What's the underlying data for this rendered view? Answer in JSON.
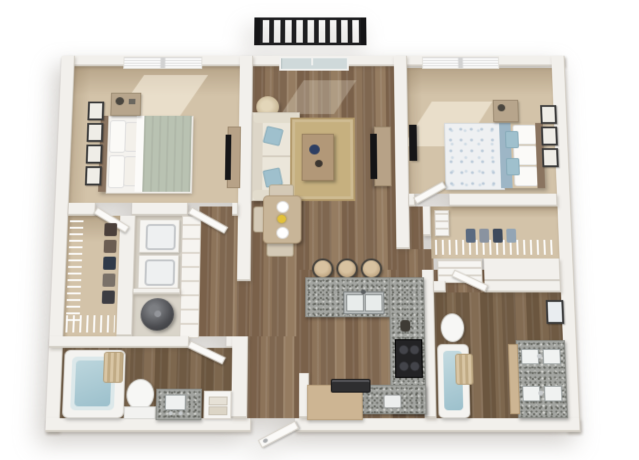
{
  "meta": {
    "render_style": "3d top-down dollhouse floor plan",
    "visible_text": ""
  },
  "palette": {
    "background": "#ffffff",
    "wall": "#f2f0ec",
    "carpet": "#d3c3a9",
    "wood": "#876e54",
    "wood_dark": "#75604a",
    "granite": "#a3a5a1",
    "counter_tan": "#cdb593",
    "rug": "#c6b07f",
    "sofa": "#ebe6da",
    "accent_blue": "#9fc0cd",
    "railing": "#1e1e20",
    "appliance_dark": "#232325",
    "sage_blanket": "#b9c2b2",
    "water": "#9cc0cc"
  },
  "balcony": {
    "railing_color": "#1e1e20",
    "bar_count": 14,
    "position": "top-center outside patio door"
  },
  "rooms": [
    {
      "name": "bedroom-1",
      "position": "top-left",
      "floor": "carpet",
      "furniture": [
        "bed with sage blanket and white pillows",
        "nightstand with lamp",
        "4 wall art frames",
        "tv console",
        "window with blinds"
      ]
    },
    {
      "name": "living-room",
      "position": "top-center",
      "floor": "hardwood",
      "furniture": [
        "sofa with 2 blue pillows",
        "floor lamp",
        "tan area rug",
        "coffee table with blue decor",
        "tv stand with tv",
        "sliding patio door"
      ]
    },
    {
      "name": "bedroom-2",
      "position": "top-right",
      "floor": "carpet",
      "furniture": [
        "bed with blue floral duvet and blue pillows",
        "nightstand",
        "3 wall art frames",
        "wall tv",
        "window with blinds"
      ]
    },
    {
      "name": "walk-in-closet-1",
      "position": "mid-left",
      "floor": "carpet",
      "furniture": [
        "wire shelving",
        "hanging clothes"
      ]
    },
    {
      "name": "laundry-utility",
      "position": "mid-left",
      "floor": "vinyl",
      "furniture": [
        "stacked washer and dryer",
        "water heater",
        "louvered doors"
      ]
    },
    {
      "name": "bathroom-1",
      "position": "bottom-left",
      "floor": "hardwood",
      "furniture": [
        "bathtub with curtain",
        "toilet",
        "granite vanity with sink",
        "towel cubby"
      ]
    },
    {
      "name": "dining-nook",
      "position": "center",
      "floor": "hardwood",
      "furniture": [
        "dining table with yellow flowers and 2 place settings",
        "3 chairs"
      ]
    },
    {
      "name": "kitchen",
      "position": "bottom-center",
      "floor": "hardwood",
      "furniture": [
        "U-shaped granite counter",
        "breakfast bar with 3 stools",
        "double stainless sink",
        "black range with 4 burners",
        "tan counter with dark appliance",
        "small white appliance"
      ]
    },
    {
      "name": "walk-in-closet-2",
      "position": "mid-right",
      "floor": "carpet",
      "furniture": [
        "wire shelf",
        "hanging clothes",
        "small shelf unit",
        "linen niche"
      ]
    },
    {
      "name": "bathroom-2",
      "position": "bottom-right",
      "floor": "hardwood",
      "furniture": [
        "bathtub with curtain",
        "toilet",
        "granite double vanity with 4 basins",
        "wall art"
      ]
    },
    {
      "name": "entry",
      "position": "bottom-center-left",
      "floor": "hardwood",
      "furniture": [
        "entry door with handle"
      ]
    }
  ],
  "counts": {
    "bar_stools": 3,
    "art_frames_bedroom1": 4,
    "art_frames_bedroom2": 3,
    "sinks_bathroom2_vanity": 4
  }
}
